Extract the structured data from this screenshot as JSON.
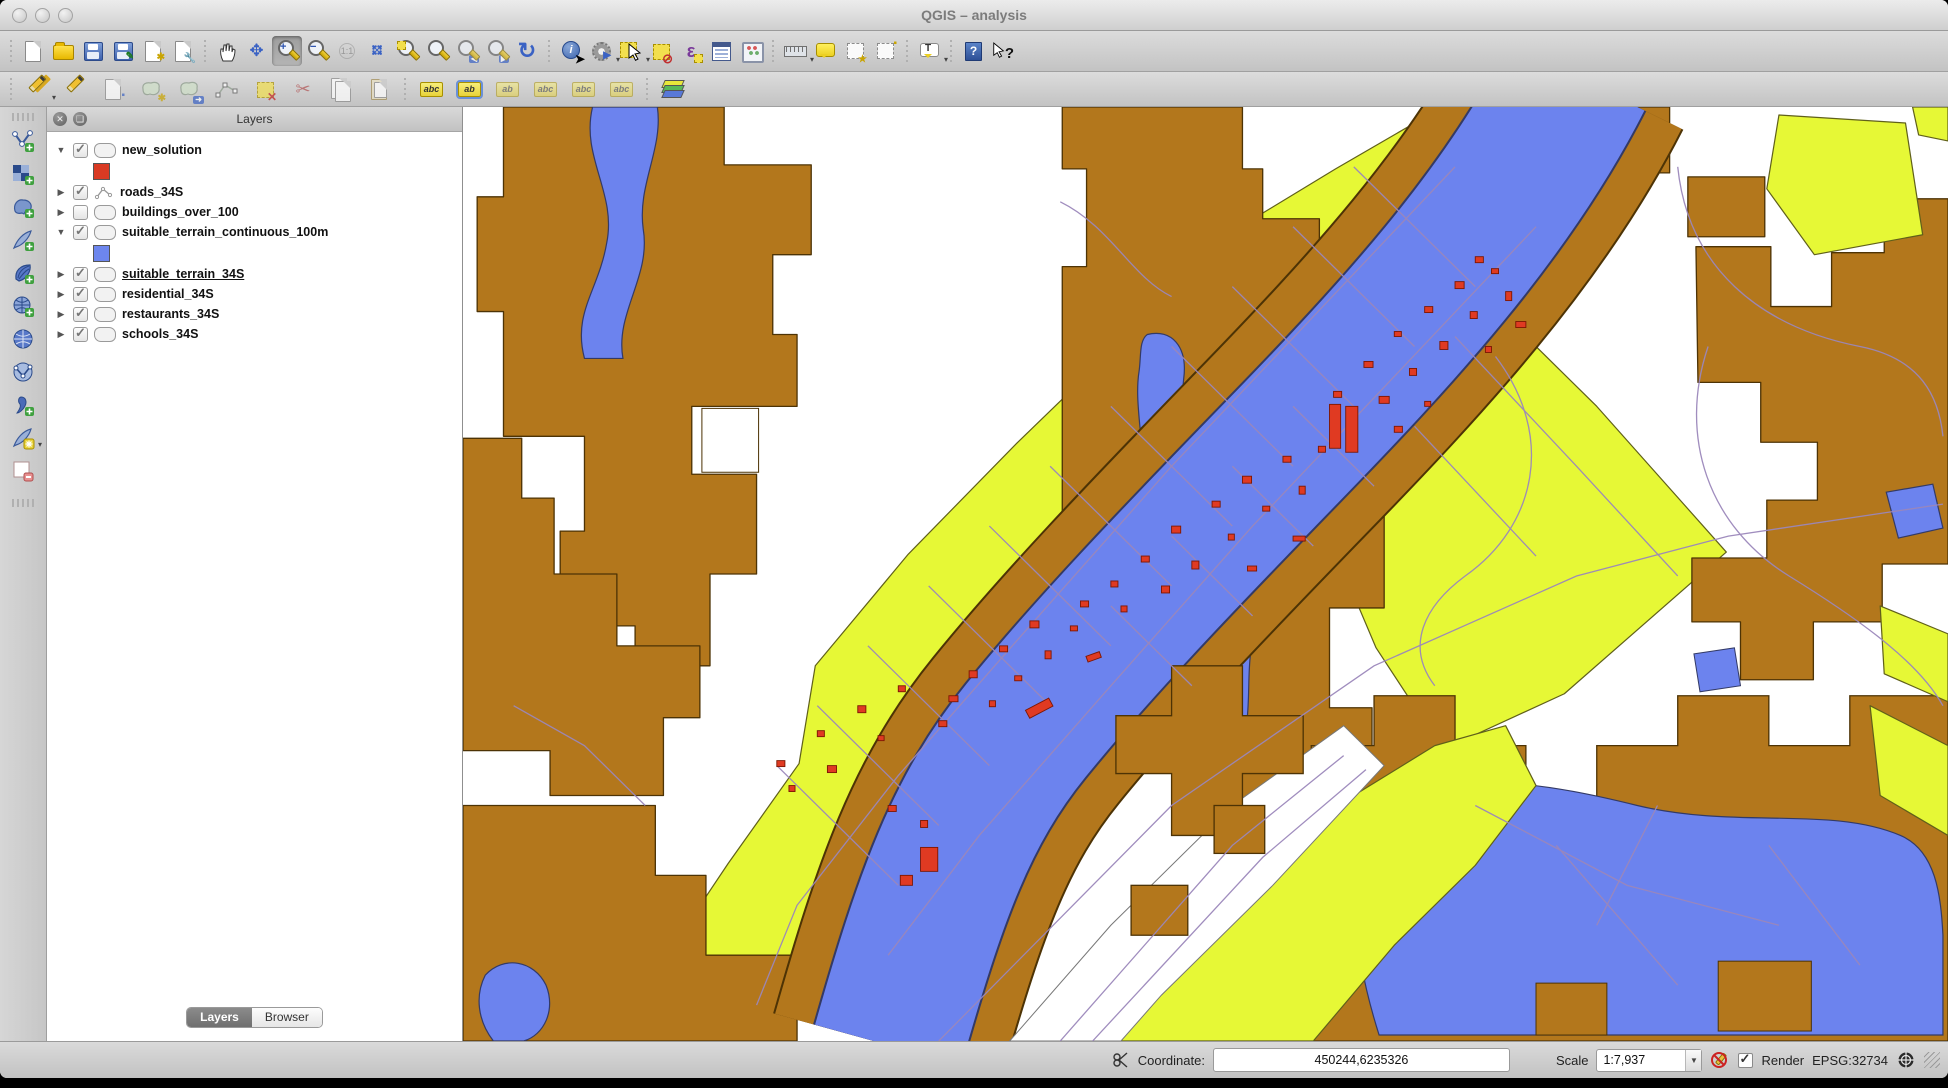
{
  "window": {
    "title": "QGIS  – analysis"
  },
  "toolbars": {
    "main": [
      "new-project",
      "open-project",
      "save-project",
      "save-project-as",
      "new-composer",
      "composer-manager",
      "pan-map",
      "pan-to-selection",
      "zoom-in",
      "zoom-out",
      "zoom-native",
      "zoom-full-extent",
      "zoom-to-selection",
      "zoom-to-layer",
      "zoom-last",
      "zoom-next",
      "refresh-map",
      "identify-features",
      "run-feature-action",
      "select-features",
      "deselect-features",
      "select-by-expression",
      "open-attribute-table",
      "field-calculator",
      "measure-line",
      "map-tips",
      "new-bookmark",
      "show-bookmarks",
      "text-annotation",
      "help-contents",
      "whats-this"
    ],
    "editing": [
      "current-edits",
      "toggle-editing",
      "save-layer-edits",
      "add-feature",
      "move-feature",
      "node-tool",
      "delete-selected",
      "cut-features",
      "copy-features",
      "paste-features",
      "layer-labeling",
      "layer-labeling-options",
      "pin-labels",
      "highlight-labels",
      "move-label",
      "rotate-label",
      "change-label",
      "processing-toolbox"
    ],
    "add_layers": [
      "add-vector-layer",
      "add-raster-layer",
      "add-postgis-layer",
      "add-spatialite-layer",
      "add-mssql-layer",
      "add-oracle-layer",
      "add-wms-layer",
      "add-wfs-layer",
      "add-delimited-text-layer",
      "new-spatialite-layer",
      "remove-layer-group"
    ]
  },
  "glyphs": {
    "abc": "abc",
    "ab": "ab",
    "one_one": "1:1",
    "epsilon": "ε",
    "letter_t": "T",
    "question": "?",
    "info": "i",
    "hand": "✋",
    "scissors": "✂",
    "refresh": "↻",
    "comma": "9"
  },
  "layers_panel": {
    "title": "Layers",
    "layers": [
      {
        "name": "new_solution",
        "checked": true,
        "expanded": true,
        "type": "polygon",
        "swatch": "#d93a23"
      },
      {
        "name": "roads_34S",
        "checked": true,
        "expanded": false,
        "type": "line"
      },
      {
        "name": "buildings_over_100",
        "checked": false,
        "expanded": false,
        "type": "polygon"
      },
      {
        "name": "suitable_terrain_continuous_100m",
        "checked": true,
        "expanded": true,
        "type": "polygon",
        "swatch": "#6d86ee"
      },
      {
        "name": "suitable_terrain_34S",
        "checked": true,
        "expanded": false,
        "type": "polygon",
        "underlined": true
      },
      {
        "name": "residential_34S",
        "checked": true,
        "expanded": false,
        "type": "polygon"
      },
      {
        "name": "restaurants_34S",
        "checked": true,
        "expanded": false,
        "type": "polygon"
      },
      {
        "name": "schools_34S",
        "checked": true,
        "expanded": false,
        "type": "polygon"
      }
    ],
    "tabs": [
      {
        "label": "Layers",
        "active": true
      },
      {
        "label": "Browser",
        "active": false
      }
    ]
  },
  "status_bar": {
    "coordinate_label": "Coordinate:",
    "coordinate_value": "450244,6235326",
    "scale_label": "Scale",
    "scale_value": "1:7,937",
    "render_label": "Render",
    "crs_label": "EPSG:32734"
  },
  "map": {
    "colors": {
      "terrain_brown": "#b3771c",
      "water_blue": "#6c83ee",
      "residential_yellow": "#e6f836",
      "building_red": "#e03a22",
      "road_line": "#9b87bb",
      "background": "#ffffff"
    }
  }
}
